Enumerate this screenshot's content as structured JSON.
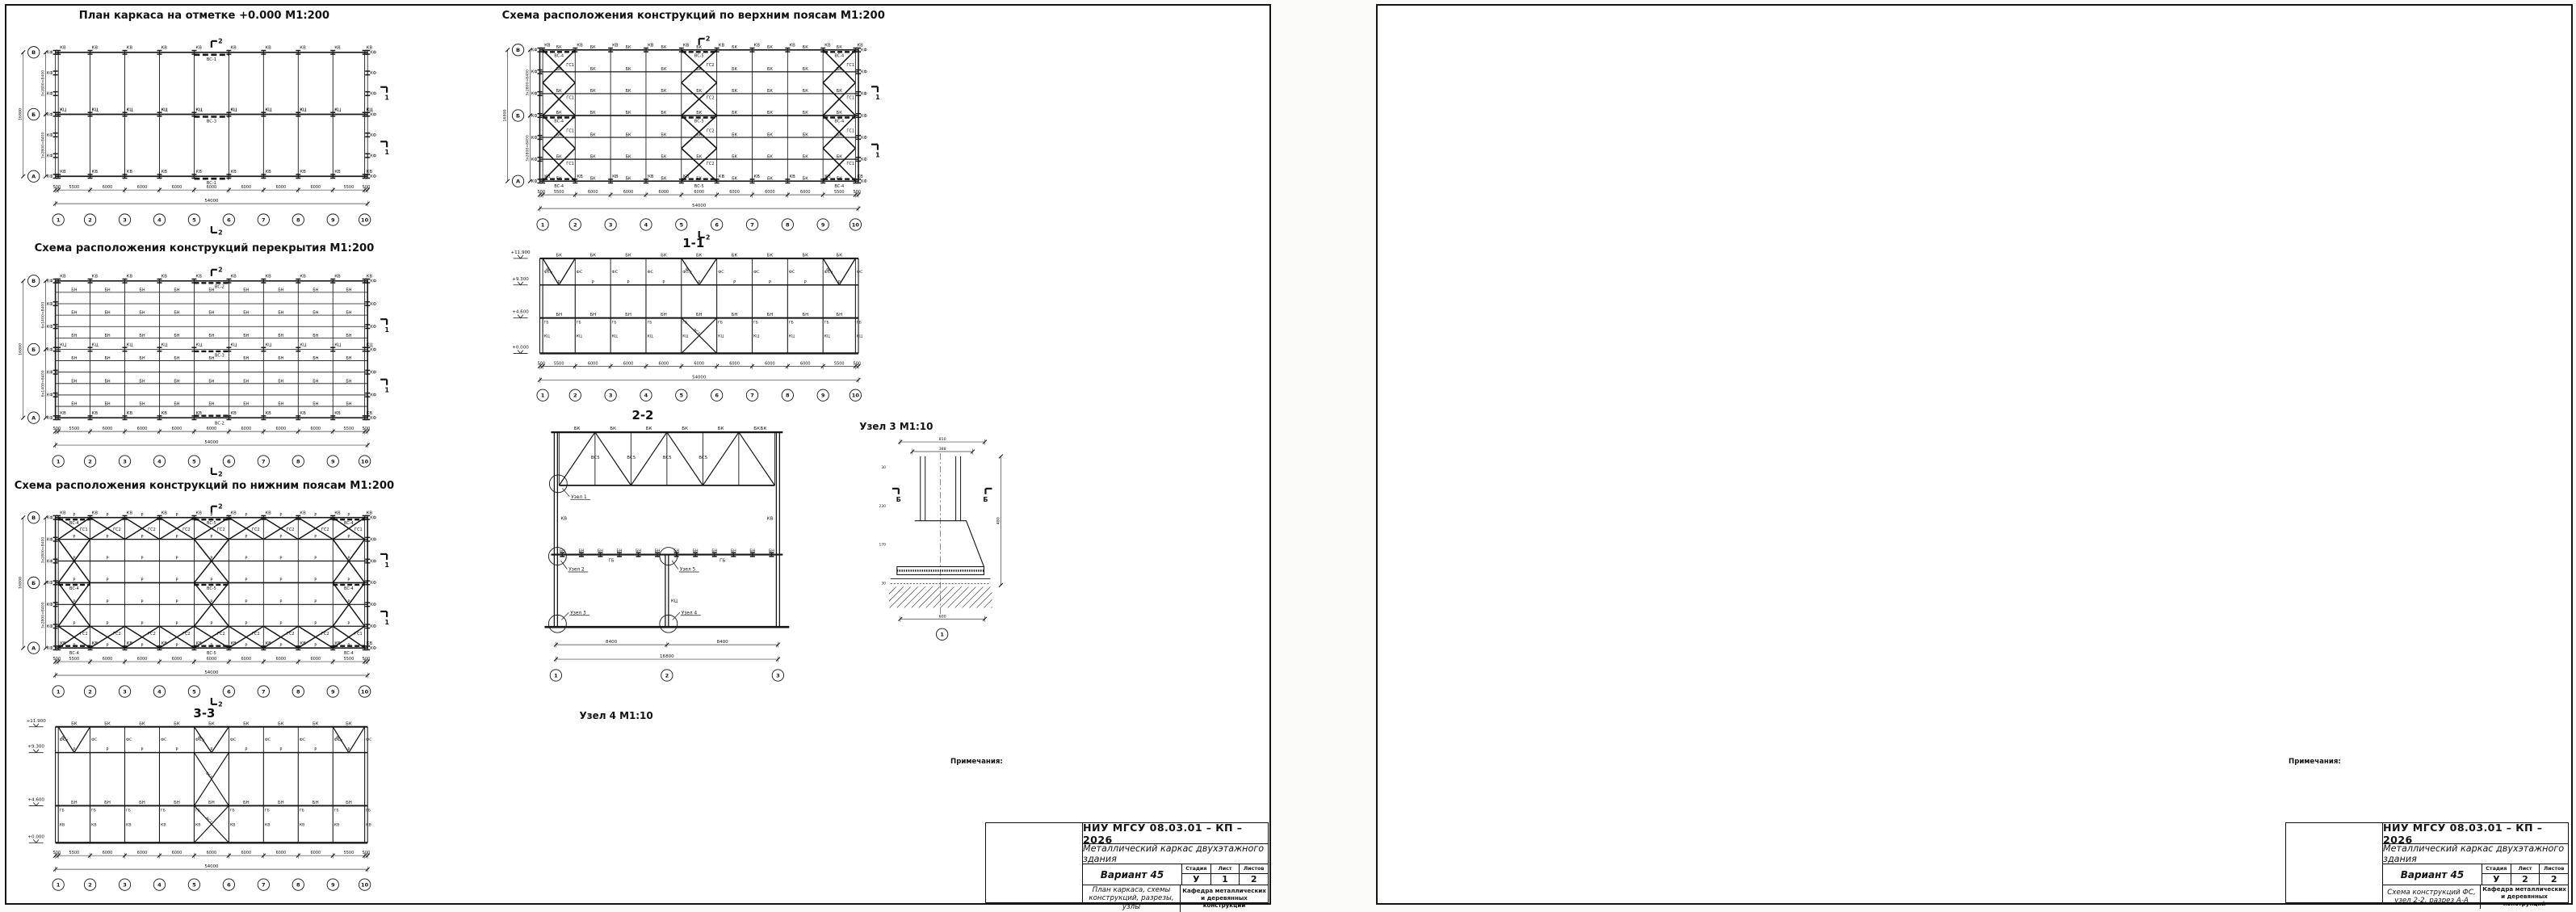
{
  "page": {
    "background": "#fbfbfa",
    "sheet_bg": "#ffffff",
    "ink": "#151515",
    "dim_color": "#3a3a3a"
  },
  "labels": {
    "kv": "КВ",
    "kts": "КЦ",
    "kf": "КФ",
    "bk": "БК",
    "bn": "БН",
    "gb": "ГБ",
    "r": "Р",
    "gs1": "ГС1",
    "gs2": "ГС2",
    "fs": "ФС",
    "vs1": "ВС-1",
    "vs2": "ВС-2",
    "vs3": "ВС-3",
    "vs4": "ВС-4",
    "vs5": "ВС-5",
    "vs3s": "ВС3",
    "vs4s": "ВС4",
    "vs5s": "ВС5",
    "vs7s": "ВС7"
  },
  "axes": {
    "numbers": [
      "1",
      "2",
      "3",
      "4",
      "5",
      "6",
      "7",
      "8",
      "9",
      "10"
    ],
    "letters": [
      "В",
      "Б",
      "А"
    ]
  },
  "dims": {
    "bays": [
      "500",
      "5500",
      "6000",
      "6000",
      "6000",
      "6000",
      "6000",
      "6000",
      "6000",
      "5500",
      "500"
    ],
    "total": "54000",
    "row": "2800",
    "v8400": "3х2800=8400",
    "v8400f": "6х1400=8400",
    "v16800": "16800"
  },
  "elevations": [
    "+11.900",
    "+9.300",
    "+4.600",
    "+0.000"
  ],
  "cuts": {
    "c1": "1",
    "c2": "2"
  },
  "sheet1": {
    "titles": {
      "plan": "План каркаса на отметке +0.000 М1:200",
      "upper": "Схема расположения конструкций по верхним поясам М1:200",
      "floor": "Схема расположения конструкций перекрытия М1:200",
      "lower": "Схема расположения конструкций по нижним поясам М1:200",
      "s11": "1-1",
      "s22": "2-2",
      "s33": "3-3",
      "node1": "Узел 1 М1:10",
      "node3": "Узел 3 М1:10",
      "node4": "Узел 4 М1:10",
      "node5": "Узел 5 М1:10",
      "rbb": "Разрез Б-Б М1:10",
      "rvv": "Разрез В-В М1:10",
      "rgg": "Разрез Г-Г М1:10"
    },
    "callouts": [
      "Узел 1",
      "Узел 2",
      "Узел 3",
      "Узел 4",
      "Узел 5"
    ],
    "s22": {
      "dims": [
        "8400",
        "8400"
      ],
      "total": "16800",
      "axes": [
        "1",
        "2",
        "3"
      ]
    },
    "node1": {
      "top": [
        "175",
        "175"
      ],
      "t16": "16",
      "d1": [
        "174",
        "56"
      ],
      "h": "2600",
      "left": [
        "60",
        "140",
        "140",
        "134"
      ],
      "misc": [
        "134",
        "30",
        "236",
        "100",
        "30",
        "68"
      ]
    },
    "node3": {
      "top": [
        "810",
        "388"
      ],
      "left": [
        "30",
        "230",
        "170",
        "30"
      ],
      "right": "480",
      "bottom": "600",
      "axis": "1",
      "flag": "Б"
    },
    "node4": {
      "top": [
        "224",
        "102",
        "102"
      ],
      "inner": "204",
      "right": [
        "290",
        "25"
      ],
      "bottom": [
        "182",
        "182"
      ],
      "btot": "364",
      "axis": "Б",
      "flag": "В"
    },
    "node5": {
      "top": [
        "62",
        "62"
      ],
      "mid": [
        "39,5",
        "39,5"
      ],
      "bottom": [
        "25",
        "102",
        "102",
        "25"
      ],
      "right": [
        "600",
        "180",
        "20"
      ],
      "flag": "Г"
    },
    "rbb": {
      "top": "800",
      "top2": "600",
      "bottom": [
        "100",
        "105",
        "16",
        "358",
        "16",
        "105",
        "100"
      ],
      "left": [
        "80",
        "180",
        "80"
      ],
      "right": [
        "40",
        "299",
        "40"
      ]
    },
    "rvv": {
      "top": "364",
      "sub": [
        "40",
        "11",
        "11",
        "40"
      ],
      "left": [
        "94",
        "22",
        "94"
      ],
      "ltot": "210",
      "right": [
        "20",
        "150",
        "30"
      ],
      "bottom": [
        "80",
        "176",
        "80"
      ],
      "b14": "14"
    },
    "rgg": {
      "top": [
        "82",
        "82"
      ],
      "t40": "40",
      "right": [
        "248",
        "600",
        "160",
        "20"
      ],
      "left": [
        "60",
        "60",
        "60",
        "17"
      ],
      "bottom": [
        "15",
        "87",
        "87",
        "15"
      ],
      "b42": [
        "42",
        "42"
      ]
    },
    "notes": {
      "header": "Примечания:",
      "items": [
        "1. Работать совместно с листом 2.",
        "2. Материал конструкций – сталь марки С255 по ГОСТ 27772-2015, спецификация в Приложении.",
        "3. Сварку выполнять полуавтоматической сваркой под флюсом проволокой Св-08А.",
        "4. Катеты и длины сварных швов приняты по расчёту.",
        "5. Болты М20, грубой точности.",
        "6. Торцы опорных фланцев фермы и опорных столиков строгать."
      ]
    },
    "titleblock": {
      "org": "НИУ МГСУ 08.03.01 – КП – 2026",
      "object": "Металлический каркас двухэтажного здания",
      "variant": "Вариант 45",
      "stage_h": "Стадия",
      "sheet_h": "Лист",
      "sheets_h": "Листов",
      "stage": "У",
      "sheet_no": "1",
      "sheets_total": "2",
      "content": "План каркаса, схемы конструкций, разрезы, узлы",
      "dept": "Кафедра металлических и деревянных конструкций",
      "rev_headers": [
        "Изм.",
        "Кол.уч",
        "Лист",
        "№док.",
        "Подп.",
        "Дата"
      ],
      "roles": [
        "Разработал",
        "Проверил"
      ]
    }
  },
  "sheet2": {
    "titles": {
      "vida": "Вид А",
      "vidb": "Вид Б",
      "truss": "Ферма стропильная (ФС)",
      "node2": "Узел 2 М1:10",
      "raa": "Разрез А-А М1:10",
      "geom": "Геометрическая схема фермы ФС М1:100"
    },
    "vida": {
      "chain": [
        "50",
        "179",
        "548,35",
        "58,34",
        "473",
        "46,67",
        "175,01",
        "201",
        "665,02",
        "81,67",
        "583,95",
        "81,67",
        "573",
        "120,17",
        "665,02",
        "81,67",
        "583,95",
        "81,67",
        "570"
      ],
      "heights": [
        "58,5",
        "58,5"
      ],
      "pairs": [
        "38,5",
        "38,5"
      ],
      "welds": [
        "6-50",
        "6-40",
        "6-40",
        "4-100",
        "4-100",
        "6-50"
      ]
    },
    "vidb": {
      "chain": [
        "30",
        "156",
        "720",
        "730",
        "105",
        "600",
        "630,02",
        "590",
        "105",
        "122",
        "400",
        "583,35"
      ],
      "leaders": [
        "58,34",
        "58,34",
        "58,33",
        "58,34",
        "128,34",
        "81,67",
        "81,67"
      ],
      "height": "222,86",
      "pairs": [
        "38,5",
        "38,5"
      ],
      "welds": [
        "6-90",
        "6-50",
        "6-130",
        "6-130",
        "6-50",
        "6-90"
      ]
    },
    "truss": {
      "panel": "2800",
      "height": "2600",
      "support": "165",
      "axis": "А",
      "welds": [
        "6-40",
        "4-40",
        "6-50",
        "8-50",
        "5-80",
        "6-90",
        "7-130",
        "6-70",
        "4-100",
        "6-40",
        "6-50"
      ],
      "misc": [
        "227",
        "180",
        "274,17",
        "50",
        "46,67",
        "200",
        "56",
        "58",
        "70",
        "50",
        "81,67",
        "81,67",
        "19,83",
        "23,26",
        "77,26",
        "39,67",
        "65,34",
        "13",
        "130",
        "100",
        "165",
        "93",
        "236",
        "68",
        "118"
      ]
    },
    "node2": {
      "left": [
        "248",
        "150",
        "270"
      ],
      "right": [
        "566",
        "120",
        "20"
      ],
      "t8": "8",
      "t12": "12",
      "flag": "А"
    },
    "raa": {
      "left": [
        "60",
        "60",
        "60"
      ],
      "l14": "14",
      "right": [
        "248",
        "600",
        "120",
        "20"
      ]
    },
    "geom": {
      "top": [
        {
          "len": "2600",
          "force": "0"
        },
        {
          "len": "2800",
          "force": "-242"
        },
        {
          "len": "2800",
          "force": "-242"
        },
        {
          "len": "2800",
          "force": "-242"
        },
        {
          "len": "2800",
          "force": "-242"
        },
        {
          "len": "2600",
          "force": "0"
        }
      ],
      "bottom": [
        {
          "len": "2600",
          "force": "176"
        },
        {
          "len": "2800",
          "force": "176"
        },
        {
          "len": "2800",
          "force": "222,6"
        },
        {
          "len": "2800",
          "force": "222,6"
        },
        {
          "len": "2800",
          "force": "176"
        },
        {
          "len": "2600",
          "force": "176"
        }
      ],
      "height": "2600",
      "end_force": "-24,4",
      "diag": [
        "-24,4",
        "+187,7",
        "-96,4",
        "+49,1",
        "-49,1",
        "+96,4",
        "-187,7",
        "-24,4"
      ]
    },
    "notes": {
      "header": "Примечания:",
      "items": [
        "1. Работать совместно с листом 1.",
        "2. Материал конструкций – сталь марки С255 по ГОСТ 27772-2015, спецификация в Приложении.",
        "3. Сварку выполнять полуавтоматической сваркой под флюсом проволокой Св-08А.",
        "4. Катеты и длины сварных швов приняты по расчёту.",
        "5. Болты М20, грубой точности.",
        "6. Торцы опорных фланцев фермы и опорных столиков строгать."
      ]
    },
    "titleblock": {
      "org": "НИУ МГСУ 08.03.01 – КП – 2026",
      "object": "Металлический каркас двухэтажного здания",
      "variant": "Вариант 45",
      "stage_h": "Стадия",
      "sheet_h": "Лист",
      "sheets_h": "Листов",
      "stage": "У",
      "sheet_no": "2",
      "sheets_total": "2",
      "content": "Схема конструкций ФС, узел 2-2, разрез А-А",
      "dept": "Кафедра металлических и деревянных конструкций",
      "rev_headers": [
        "Изм.",
        "Кол.уч",
        "Лист",
        "№док.",
        "Подп.",
        "Дата"
      ],
      "roles": [
        "Разработал",
        "Проверил"
      ]
    }
  }
}
